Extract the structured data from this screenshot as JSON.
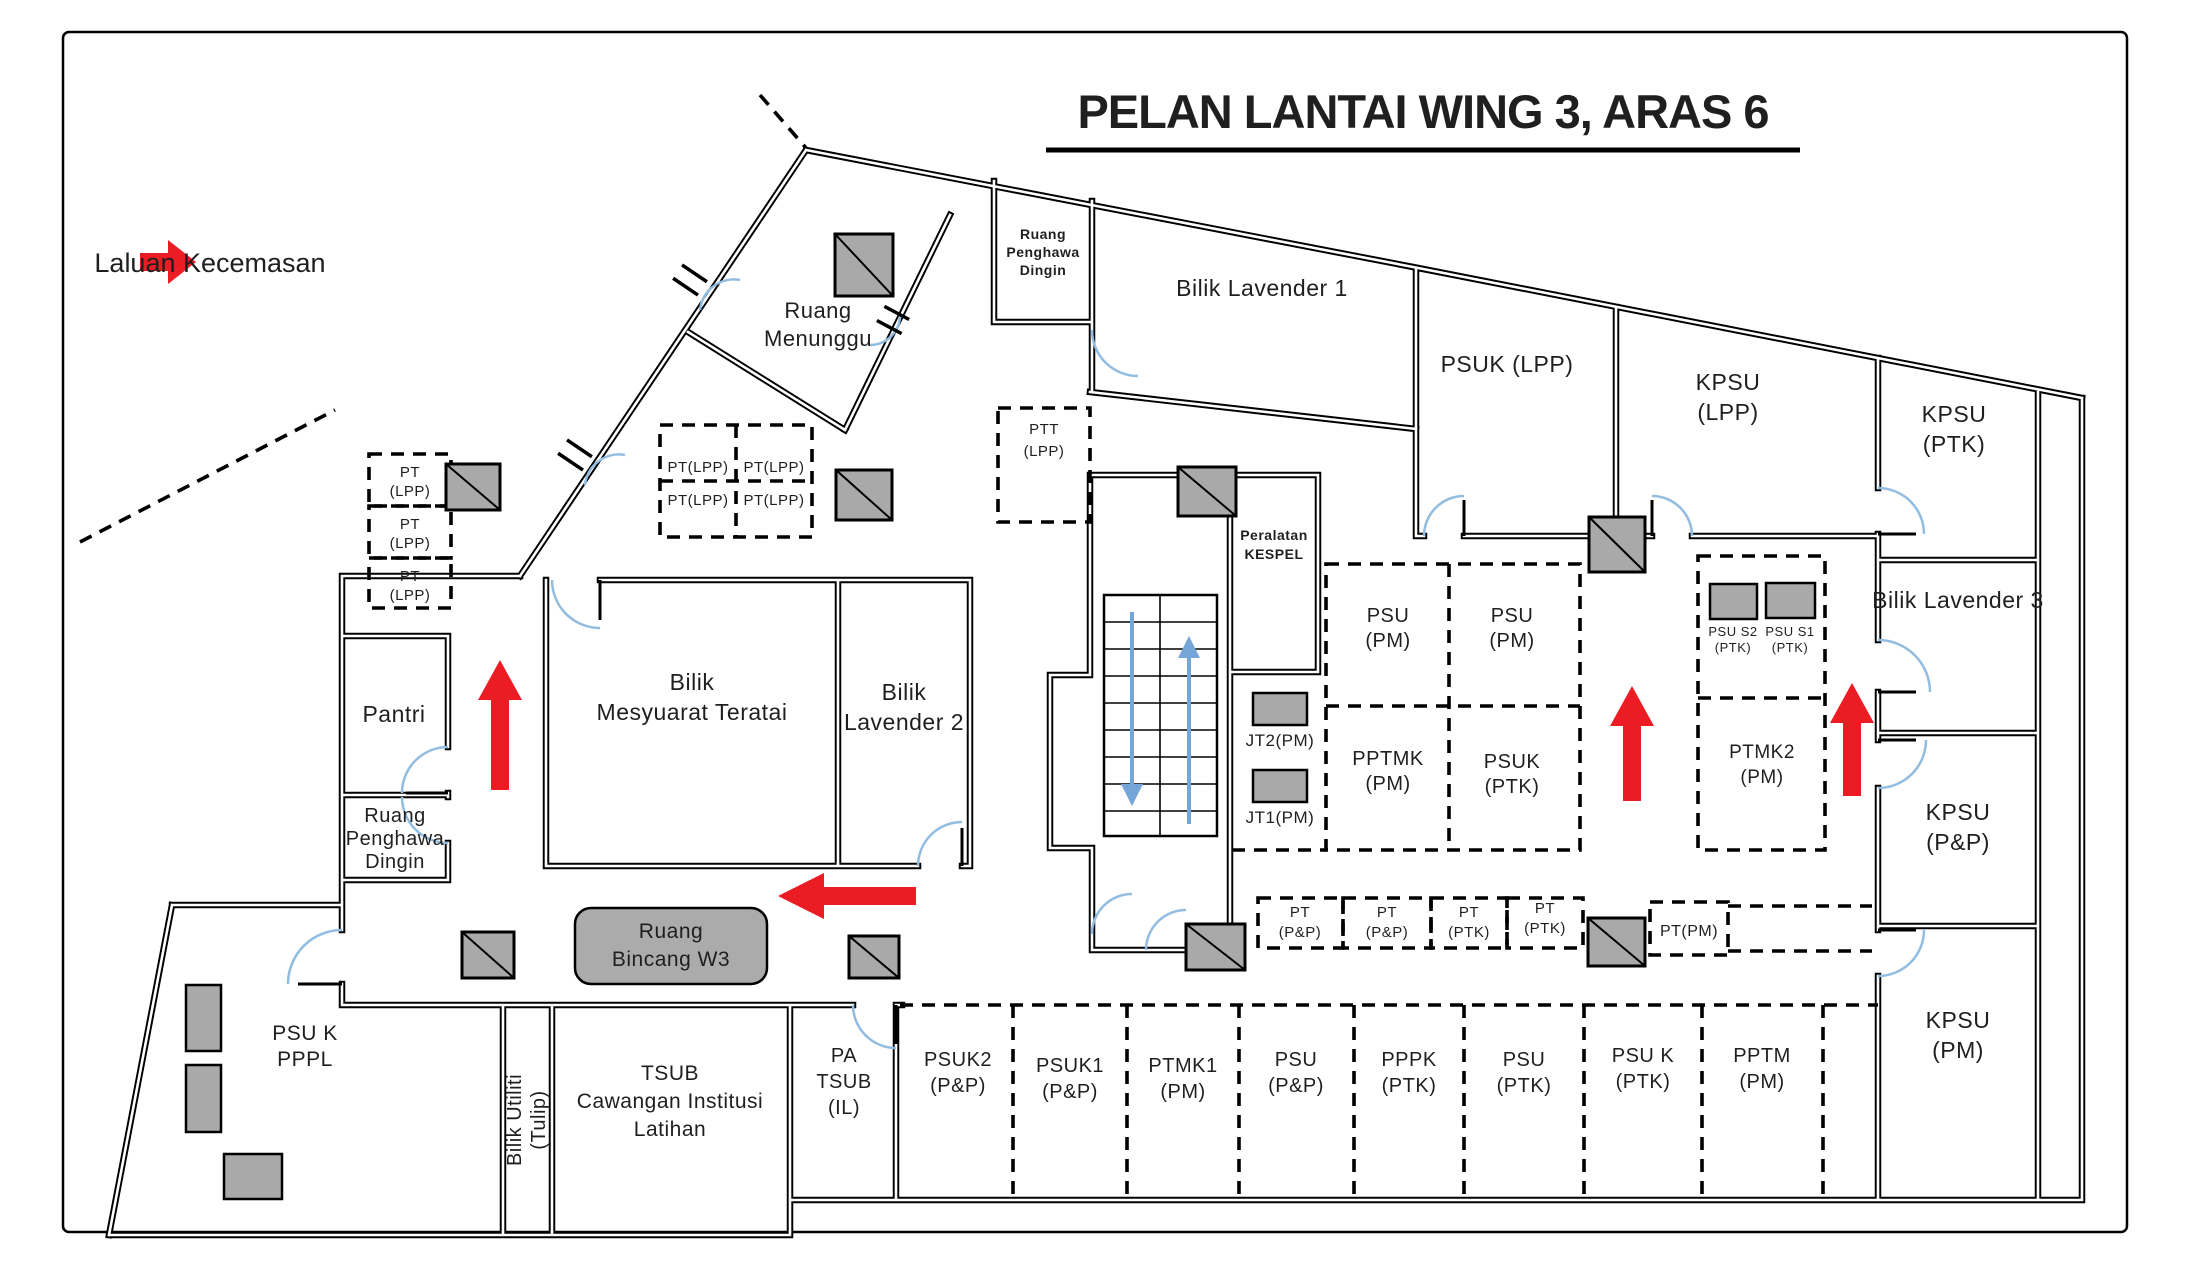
{
  "title": "PELAN LANTAI WING 3, ARAS 6",
  "legend": {
    "label": "Laluan Kecemasan"
  },
  "colors": {
    "emergency_red": "#ec1c24",
    "pillar_gray": "#a9a9a9",
    "furniture_gray": "#a9a9a9",
    "bincang_gray": "#ababab",
    "door_arc_blue": "#92bce0",
    "stair_arrow_blue": "#76a5d8"
  },
  "rooms": {
    "ruang_menunggu": {
      "l1": "Ruang",
      "l2": "Menunggu"
    },
    "ruang_penghawa_dingin_atas": {
      "l1": "Ruang",
      "l2": "Penghawa",
      "l3": "Dingin"
    },
    "bilik_lavender_1": {
      "l1": "Bilik Lavender 1"
    },
    "psuk_lpp": {
      "l1": "PSUK  (LPP)"
    },
    "kpsu_lpp": {
      "l1": "KPSU",
      "l2": "(LPP)"
    },
    "kpsu_ptk": {
      "l1": "KPSU",
      "l2": "(PTK)"
    },
    "bilik_lavender_3": {
      "l1": "Bilik Lavender 3"
    },
    "kpsu_pnp": {
      "l1": "KPSU",
      "l2": "(P&P)"
    },
    "kpsu_pm": {
      "l1": "KPSU",
      "l2": "(PM)"
    },
    "pantri": {
      "l1": "Pantri"
    },
    "ruang_penghawa_dingin_kiri": {
      "l1": "Ruang",
      "l2": "Penghawa",
      "l3": "Dingin"
    },
    "bilik_mesyuarat_teratai": {
      "l1": "Bilik",
      "l2": "Mesyuarat Teratai"
    },
    "bilik_lavender_2": {
      "l1": "Bilik",
      "l2": "Lavender 2"
    },
    "peralatan_kespel": {
      "l1": "Peralatan",
      "l2": "KESPEL"
    },
    "ruang_bincang_w3": {
      "l1": "Ruang",
      "l2": "Bincang W3"
    },
    "psu_k_pppl": {
      "l1": "PSU K",
      "l2": "PPPL"
    },
    "bilik_utiliti_tulip": {
      "l1": "Bilik Utiliti",
      "l2": "(Tulip)"
    },
    "tsub": {
      "l1": "TSUB",
      "l2": "Cawangan Institusi",
      "l3": "Latihan"
    },
    "pa_tsub_il": {
      "l1": "PA",
      "l2": "TSUB",
      "l3": "(IL)"
    }
  },
  "cubicles": {
    "pt_lpp_1": {
      "l1": "PT",
      "l2": "(LPP)"
    },
    "pt_lpp_2": {
      "l1": "PT",
      "l2": "(LPP)"
    },
    "pt_lpp_3": {
      "l1": "PT",
      "l2": "(LPP)"
    },
    "pt_lpp_g1": {
      "l1": "PT(LPP)"
    },
    "pt_lpp_g2": {
      "l1": "PT(LPP)"
    },
    "pt_lpp_g3": {
      "l1": "PT(LPP)"
    },
    "pt_lpp_g4": {
      "l1": "PT(LPP)"
    },
    "ptt_lpp": {
      "l1": "PTT",
      "l2": "(LPP)"
    },
    "psu_pm_a": {
      "l1": "PSU",
      "l2": "(PM)"
    },
    "psu_pm_b": {
      "l1": "PSU",
      "l2": "(PM)"
    },
    "pptmk_pm": {
      "l1": "PPTMK",
      "l2": "(PM)"
    },
    "psuk_ptk": {
      "l1": "PSUK",
      "l2": "(PTK)"
    },
    "psu_s2_ptk": {
      "l1": "PSU S2",
      "l2": "(PTK)"
    },
    "psu_s1_ptk": {
      "l1": "PSU S1",
      "l2": "(PTK)"
    },
    "ptmk2_pm": {
      "l1": "PTMK2",
      "l2": "(PM)"
    },
    "pt_pnp_a": {
      "l1": "PT",
      "l2": "(P&P)"
    },
    "pt_pnp_b": {
      "l1": "PT",
      "l2": "(P&P)"
    },
    "pt_ptk_a": {
      "l1": "PT",
      "l2": "(PTK)"
    },
    "pt_ptk_b": {
      "l1": "PT",
      "l2": "(PTK)"
    },
    "pt_pm": {
      "l1": "PT(PM)"
    },
    "psuk2_pnp": {
      "l1": "PSUK2",
      "l2": "(P&P)"
    },
    "psuk1_pnp": {
      "l1": "PSUK1",
      "l2": "(P&P)"
    },
    "ptmk1_pm": {
      "l1": "PTMK1",
      "l2": "(PM)"
    },
    "psu_pnp": {
      "l1": "PSU",
      "l2": "(P&P)"
    },
    "pppk_ptk": {
      "l1": "PPPK",
      "l2": "(PTK)"
    },
    "psu_ptk": {
      "l1": "PSU",
      "l2": "(PTK)"
    },
    "psu_k_ptk": {
      "l1": "PSU K",
      "l2": "(PTK)"
    },
    "pptm_pm": {
      "l1": "PPTM",
      "l2": "(PM)"
    }
  },
  "fixtures": {
    "jt2_pm": {
      "label": "JT2(PM)"
    },
    "jt1_pm": {
      "label": "JT1(PM)"
    }
  }
}
